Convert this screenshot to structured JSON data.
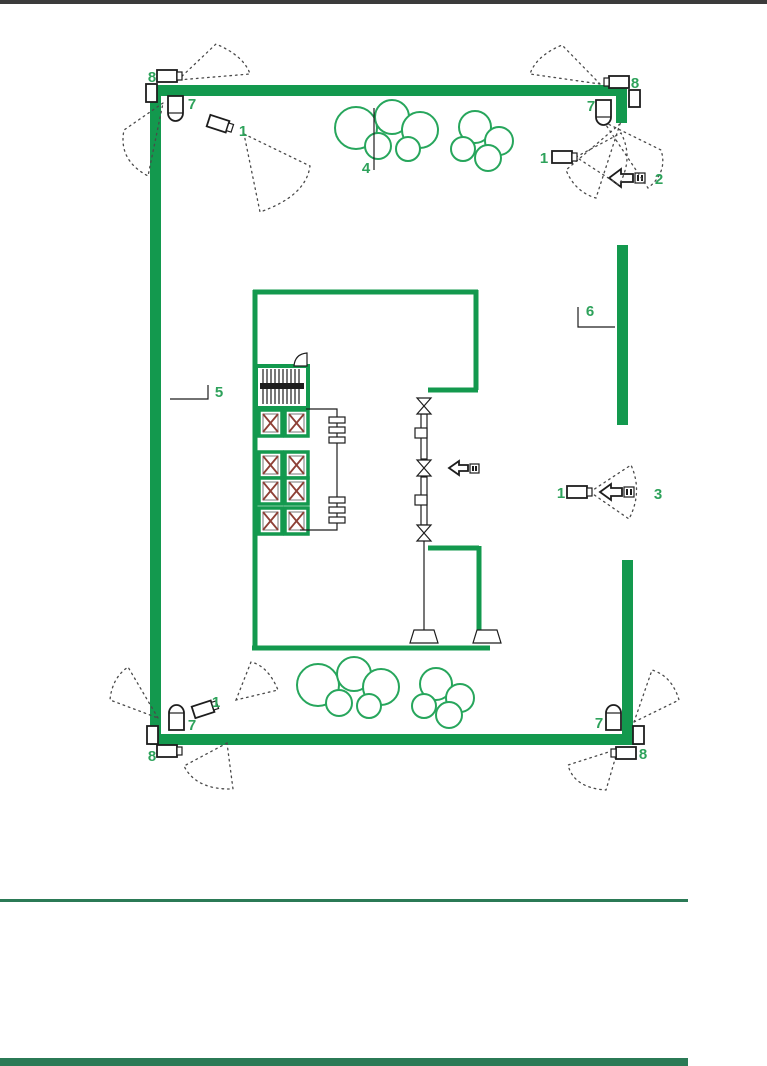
{
  "colors": {
    "wall": "#13994E",
    "tree": "#27A65C",
    "label": "#2EA25B",
    "ink": "#1d1d1d",
    "elevx": "#8E4036",
    "toprule": "#3B3B3B",
    "footrule": "#2B7A56"
  },
  "labels": {
    "tl_8": "8",
    "tl_7": "7",
    "tl_1": "1",
    "tree_4": "4",
    "tr_1": "1",
    "tr_2": "2",
    "tr_7": "7",
    "tr_8": "8",
    "fence_6": "6",
    "wall_5": "5",
    "mr_1": "1",
    "mr_3": "3",
    "bl_1": "1",
    "bl_7": "7",
    "bl_8": "8",
    "br_7": "7",
    "br_8": "8"
  }
}
